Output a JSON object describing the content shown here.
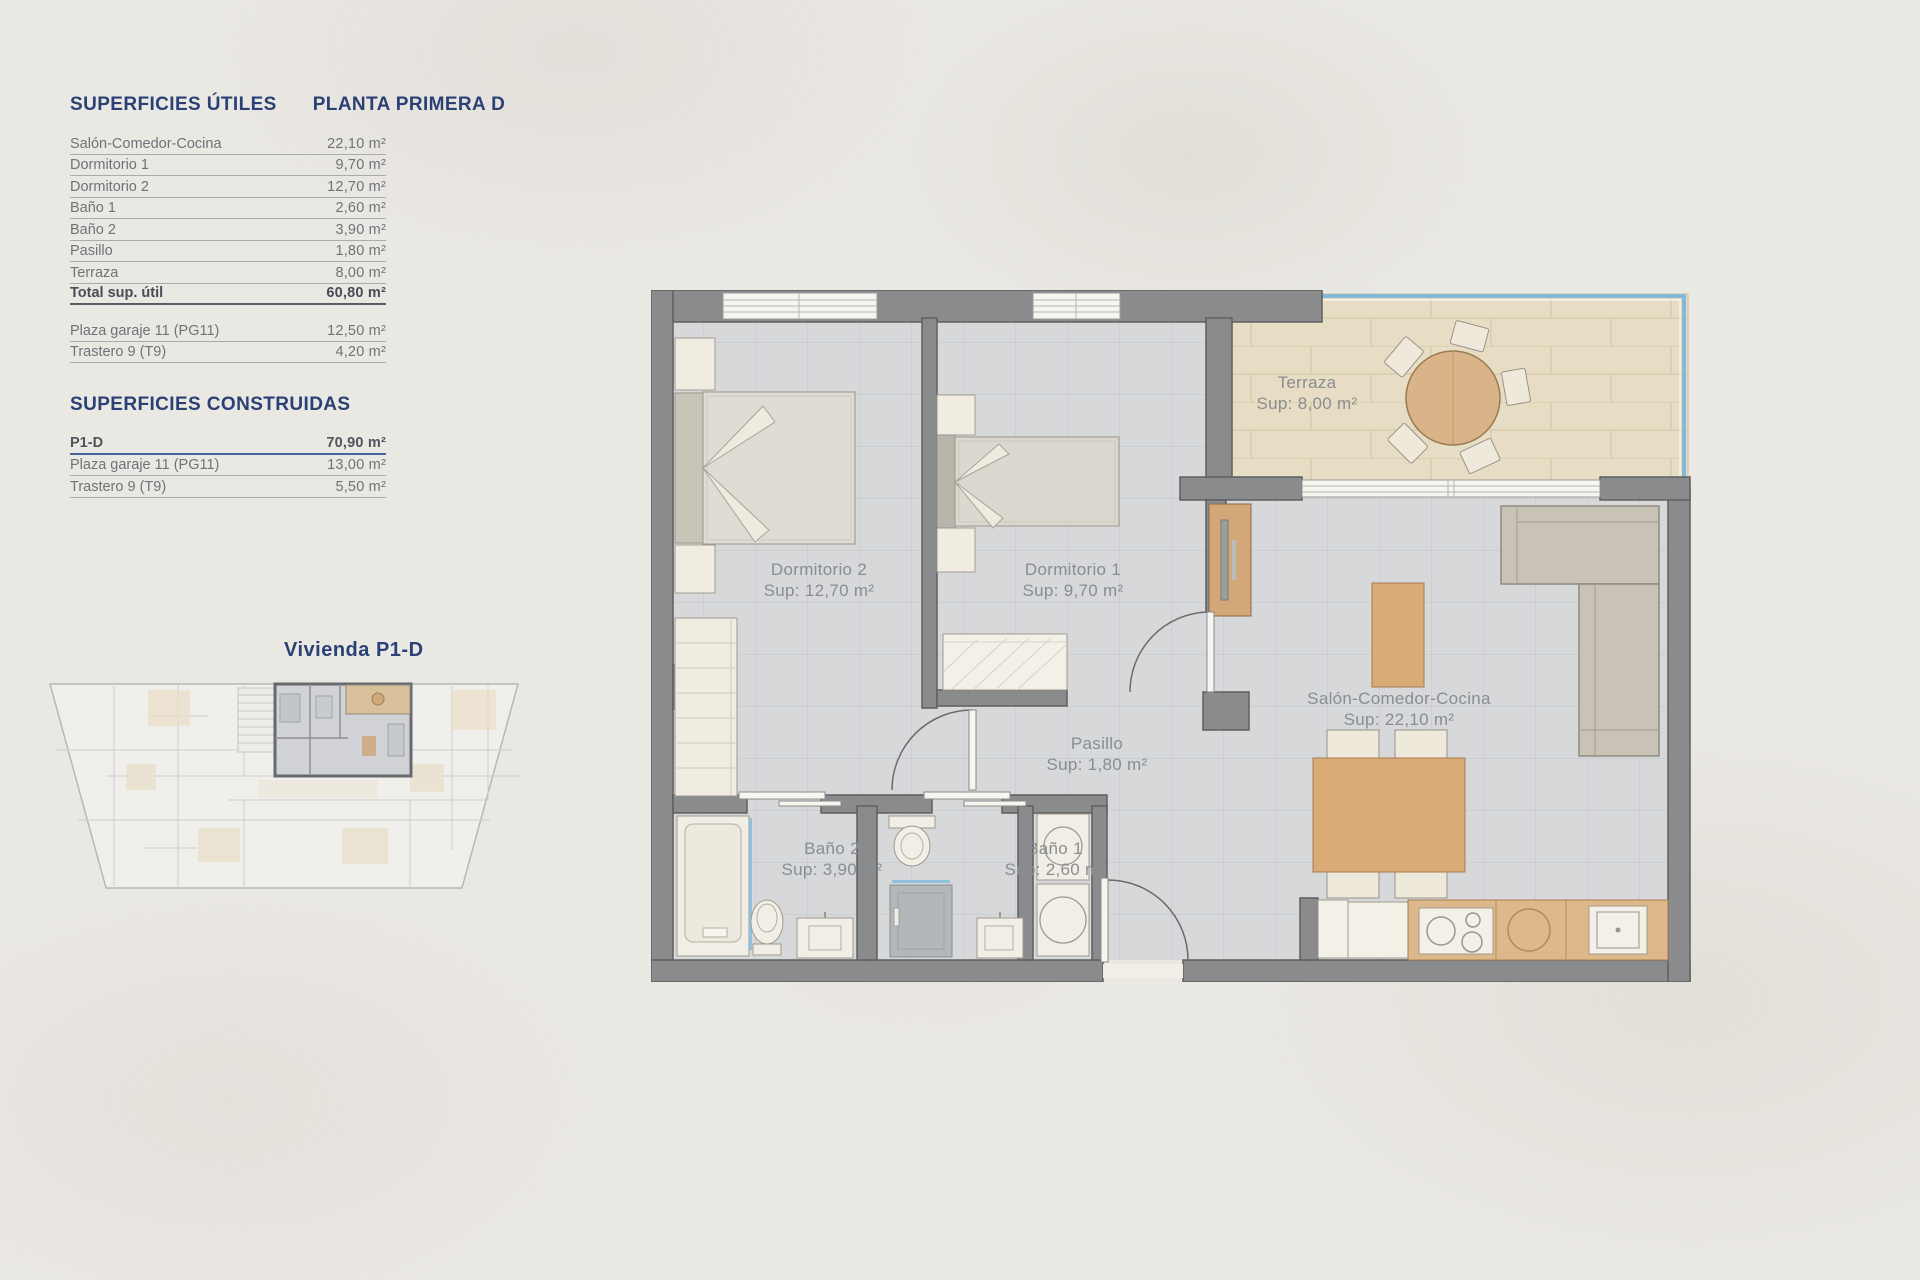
{
  "colors": {
    "navy": "#2b4176",
    "text": "#6f7379",
    "line": "#a9abae",
    "accent": "#47659e",
    "wall": "#8a8b8c",
    "wall-edge": "#5e5f61",
    "floor": "#d6d8da",
    "floor-line": "#c5c8cb",
    "terrace": "#e7ddc4",
    "terrace-line": "#d6c9a9",
    "wood": "#d9ab76",
    "rail": "#85b8d8"
  },
  "panel": {
    "useful_title": "SUPERFICIES ÚTILES",
    "plan_title": "PLANTA PRIMERA D",
    "useful_rows": [
      {
        "label": "Salón-Comedor-Cocina",
        "value": "22,10 m²"
      },
      {
        "label": "Dormitorio 1",
        "value": "9,70 m²"
      },
      {
        "label": "Dormitorio 2",
        "value": "12,70 m²"
      },
      {
        "label": "Baño 1",
        "value": "2,60 m²"
      },
      {
        "label": "Baño 2",
        "value": "3,90 m²"
      },
      {
        "label": "Pasillo",
        "value": "1,80 m²"
      },
      {
        "label": "Terraza",
        "value": "8,00 m²"
      }
    ],
    "useful_total": {
      "label": "Total sup. útil",
      "value": "60,80 m²"
    },
    "useful_extras": [
      {
        "label": "Plaza garaje 11 (PG11)",
        "value": "12,50 m²"
      },
      {
        "label": "Trastero 9 (T9)",
        "value": "4,20 m²"
      }
    ],
    "built_title": "SUPERFICIES CONSTRUIDAS",
    "built_rows": [
      {
        "label": "P1-D",
        "value": "70,90 m²"
      },
      {
        "label": "Plaza garaje 11 (PG11)",
        "value": "13,00 m²"
      },
      {
        "label": "Trastero 9 (T9)",
        "value": "5,50 m²"
      }
    ],
    "unit_label": "Vivienda P1-D"
  },
  "plan": {
    "labels": [
      {
        "name": "Terraza",
        "sup": "Sup: 8,00 m²"
      },
      {
        "name": "Dormitorio 2",
        "sup": "Sup: 12,70 m²"
      },
      {
        "name": "Dormitorio 1",
        "sup": "Sup: 9,70 m²"
      },
      {
        "name": "Salón-Comedor-Cocina",
        "sup": "Sup: 22,10 m²"
      },
      {
        "name": "Pasillo",
        "sup": "Sup: 1,80 m²"
      },
      {
        "name": "Baño 2",
        "sup": "Sup: 3,90 m²"
      },
      {
        "name": "Baño 1",
        "sup": "Sup: 2,60 m²"
      }
    ]
  }
}
